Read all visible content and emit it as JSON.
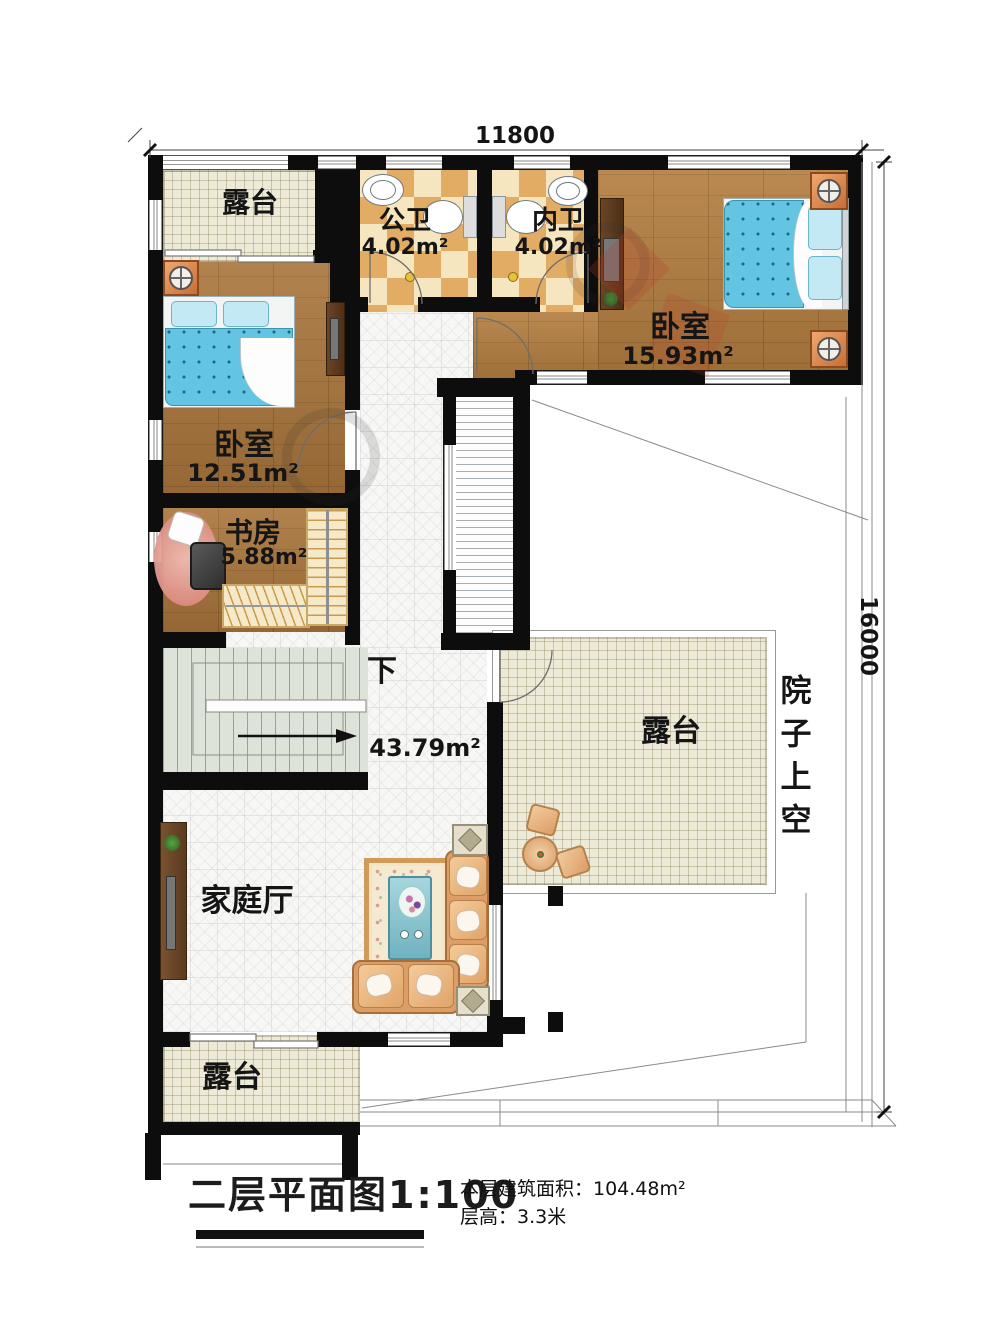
{
  "plan": {
    "dimensions": {
      "top": "11800",
      "right": "16000"
    },
    "rooms": {
      "terrace_top": {
        "label": "露台"
      },
      "bath_public": {
        "label": "公卫",
        "area": "4.02m²"
      },
      "bath_inner": {
        "label": "内卫",
        "area": "4.02m²"
      },
      "bedroom_right": {
        "label": "卧室",
        "area": "15.93m²"
      },
      "bedroom_left": {
        "label": "卧室",
        "area": "12.51m²"
      },
      "study": {
        "label": "书房",
        "area": "5.88m²"
      },
      "stairs": {
        "label": "下"
      },
      "hall": {
        "label": "家庭厅",
        "area": "43.79m²"
      },
      "terrace_mid": {
        "label": "露台"
      },
      "terrace_bottom": {
        "label": "露台"
      },
      "courtyard_void": {
        "label": "院子上空"
      }
    },
    "footer": {
      "title": "二层平面图1:100",
      "building_area": "本层建筑面积：104.48m²",
      "floor_height": "层高：3.3米"
    },
    "colors": {
      "wall": "#0d0d0d",
      "wood_floor": "#b27c3e",
      "bathroom_checker": "#e2ac64",
      "terrace": "#edead8",
      "bed": "#64c5e2",
      "stairs": "#dee3da"
    }
  }
}
